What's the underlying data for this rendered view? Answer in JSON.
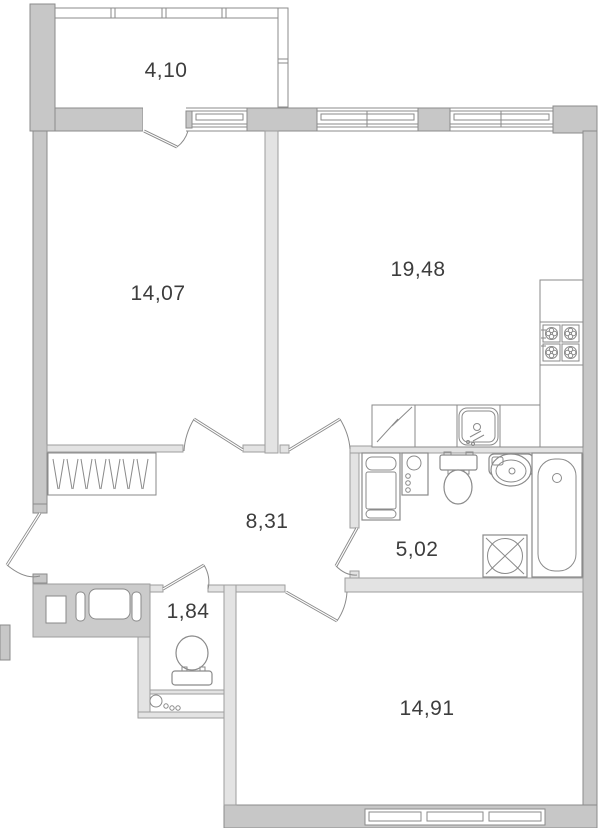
{
  "title": "apartment-floor-plan",
  "colors": {
    "wall_exterior": "#c7c7c7",
    "wall_interior": "#e3e3e3",
    "vent_block": "#cbcbcb",
    "outline": "#8b8b8b",
    "outline_light": "#9e9e9e",
    "fixture": "#8a8a8a",
    "text": "#3d3d3d",
    "background": "#ffffff"
  },
  "rooms": [
    {
      "id": "balcony",
      "area_label": "4,10"
    },
    {
      "id": "bedroom",
      "area_label": "14,07"
    },
    {
      "id": "kitchen-living-room",
      "area_label": "19,48"
    },
    {
      "id": "hallway",
      "area_label": "8,31"
    },
    {
      "id": "bathroom",
      "area_label": "5,02"
    },
    {
      "id": "wc",
      "area_label": "1,84"
    },
    {
      "id": "bedroom-2",
      "area_label": "14,91"
    }
  ],
  "icons": [
    "window-icon",
    "door-icon",
    "balcony-glazing-icon",
    "wardrobe-icon",
    "vent-shaft-icon",
    "fridge-icon",
    "kitchen-sink-icon",
    "stove-icon",
    "cabinet-icon",
    "riser-icon",
    "toilet-icon",
    "washbasin-icon",
    "bathtub-icon",
    "washing-machine-icon"
  ]
}
